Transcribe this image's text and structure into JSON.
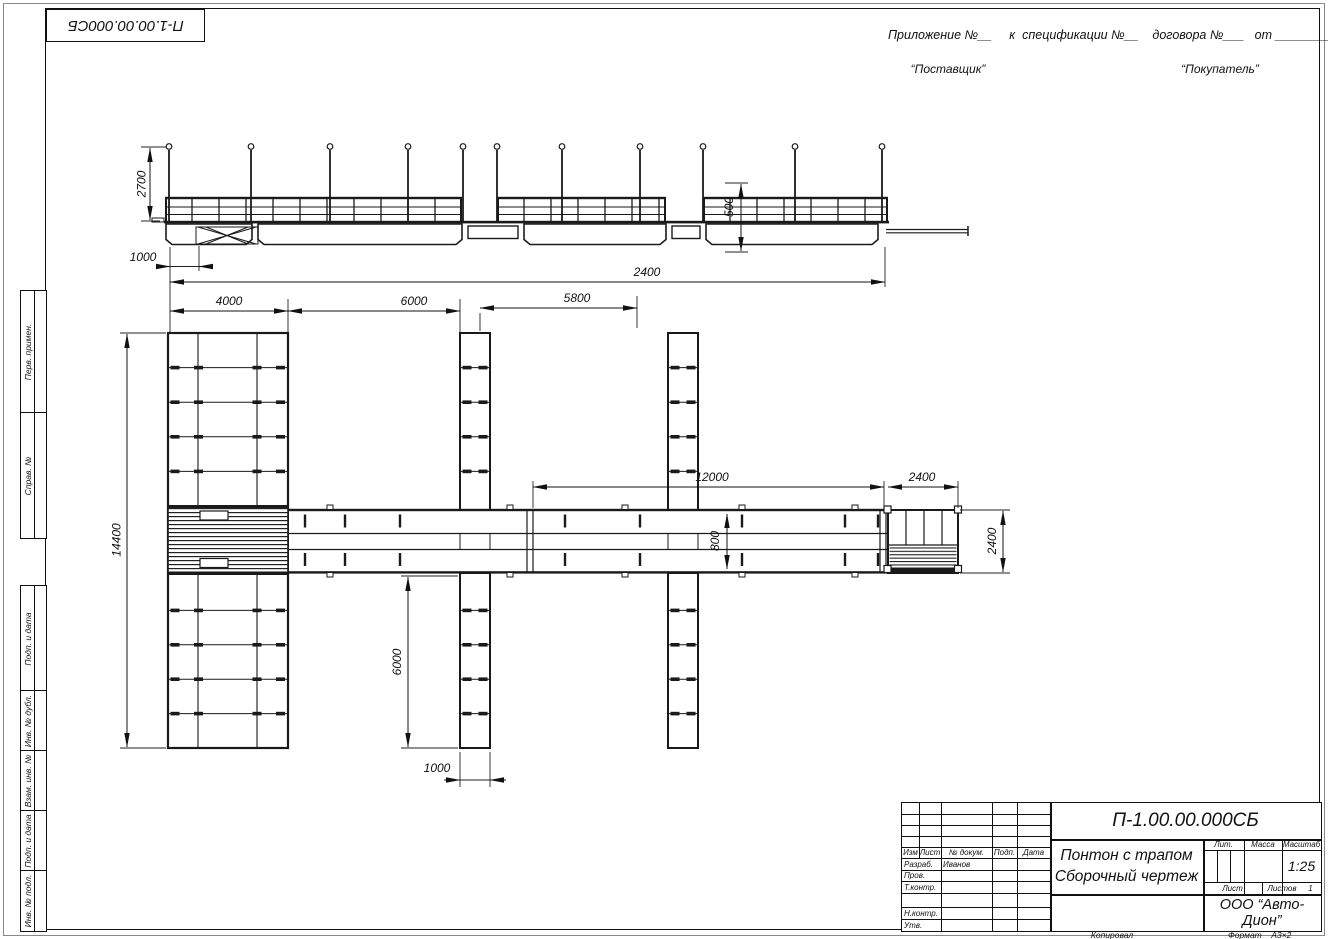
{
  "page": {
    "doc_number_top": "П-1.00.00.000СБ",
    "header": {
      "annex_line": "Приложение №__     к  спецификации №__    договора №___   от ________",
      "supplier": "“Поставщик”",
      "buyer": "“Покупатель”"
    }
  },
  "margin_labels": [
    "Перв. примен.",
    "Справ. №",
    "Подп. и дата",
    "Инв. № дубл.",
    "Взам. инв. №",
    "Подп. и дата",
    "Инв. № подл."
  ],
  "dimensions": {
    "d2700": "2700",
    "d1000_elev": "1000",
    "d2400_elev": "2400",
    "d500": "500",
    "d4000": "4000",
    "d6000_top": "6000",
    "d5800": "5800",
    "d12000": "12000",
    "d2400_plan": "2400",
    "d14400": "14400",
    "d6000_pier": "6000",
    "d1000_pier": "1000",
    "d800": "800",
    "d2400_end": "2400"
  },
  "title_block": {
    "doc_number": "П-1.00.00.000СБ",
    "title_line1": "Понтон с трапом",
    "title_line2": "Сборочный чертеж",
    "col_izm": "Изм",
    "col_list": "Лист",
    "col_doc": "№ докум.",
    "col_sign": "Подп.",
    "col_date": "Дата",
    "row_razrab": "Разраб.",
    "row_prov": "Пров.",
    "row_tkontr": "Т.контр.",
    "row_nkontr": "Н.контр.",
    "row_utv": "Утв.",
    "razrab_name": "Иванов",
    "lit_label": "Лит.",
    "mass_label": "Масса",
    "scale_label": "Масштаб",
    "scale_value": "1:25",
    "sheet_label": "Лист",
    "sheets_label": "Листов",
    "sheets_value": "1",
    "company": "ООО “Авто-Дион”",
    "copied": "Копировал",
    "format_label": "Формат",
    "format_value": "А3×2"
  }
}
